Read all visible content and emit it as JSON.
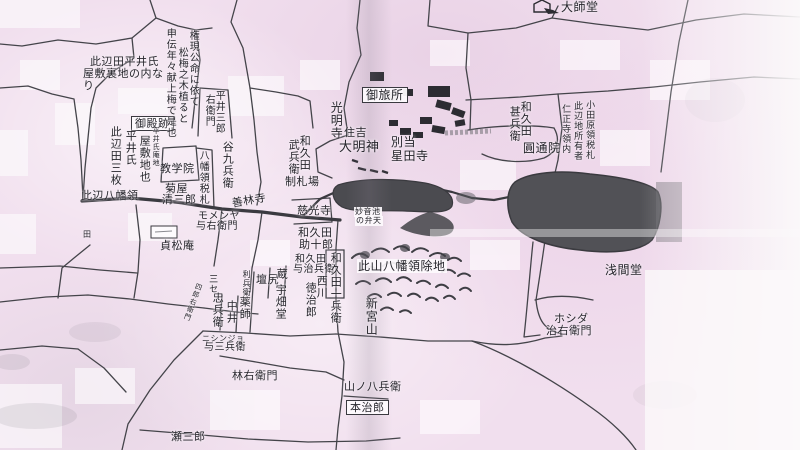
{
  "canvas": {
    "width": 800,
    "height": 450
  },
  "colors": {
    "paper_pink": "#f1dfee",
    "ink": "#26262c",
    "road": "#44444a",
    "road_main": "#3a3a40",
    "pond_fill": "#515156",
    "hill_stroke": "#3e3e44",
    "margin_white": "#fbf9fa"
  },
  "labels": [
    {
      "text": "大師堂",
      "x": 561,
      "y": 1,
      "dir": "h",
      "size": 12
    },
    {
      "text": "御旅所",
      "x": 362,
      "y": 87,
      "dir": "h",
      "size": 12,
      "box": true
    },
    {
      "text": "住吉",
      "x": 344,
      "y": 127,
      "dir": "h",
      "size": 11
    },
    {
      "text": "大明神",
      "x": 339,
      "y": 141,
      "dir": "h",
      "size": 13
    },
    {
      "text": "別当",
      "x": 391,
      "y": 136,
      "dir": "h",
      "size": 12
    },
    {
      "text": "星田寺",
      "x": 391,
      "y": 150,
      "dir": "h",
      "size": 12
    },
    {
      "text": "制札場",
      "x": 285,
      "y": 176,
      "dir": "h",
      "size": 11
    },
    {
      "text": "圓通院",
      "x": 523,
      "y": 142,
      "dir": "h",
      "size": 12
    },
    {
      "text": "教学院",
      "x": 160,
      "y": 163,
      "dir": "h",
      "size": 11
    },
    {
      "text": "菊屋",
      "x": 165,
      "y": 183,
      "dir": "h",
      "size": 11
    },
    {
      "text": "清三郎",
      "x": 162,
      "y": 194,
      "dir": "h",
      "size": 11
    },
    {
      "text": "此辺八幡領",
      "x": 81,
      "y": 190,
      "dir": "h",
      "size": 11
    },
    {
      "text": "善林寺",
      "x": 231,
      "y": 198,
      "dir": "h",
      "size": 11,
      "rot": -10
    },
    {
      "text": "慈光寺",
      "x": 297,
      "y": 205,
      "dir": "h",
      "size": 11
    },
    {
      "text": "モメンヤ",
      "x": 198,
      "y": 212,
      "dir": "h",
      "size": 10
    },
    {
      "text": "与右衛門",
      "x": 196,
      "y": 222,
      "dir": "h",
      "size": 10
    },
    {
      "text": "貞松庵",
      "x": 160,
      "y": 240,
      "dir": "h",
      "size": 11
    },
    {
      "text": "妙音池",
      "x": 354,
      "y": 207,
      "dir": "h",
      "size": 8,
      "bg": true
    },
    {
      "text": "の弁天",
      "x": 355,
      "y": 216,
      "dir": "h",
      "size": 8,
      "bg": true
    },
    {
      "text": "此山八幡領除地",
      "x": 357,
      "y": 259,
      "dir": "h",
      "size": 12,
      "bg": true
    },
    {
      "text": "浅間堂",
      "x": 605,
      "y": 264,
      "dir": "h",
      "size": 12
    },
    {
      "text": "ホシダ",
      "x": 554,
      "y": 313,
      "dir": "h",
      "size": 11
    },
    {
      "text": "治右衛門",
      "x": 546,
      "y": 325,
      "dir": "h",
      "size": 11
    },
    {
      "text": "ニシンジョ",
      "x": 202,
      "y": 335,
      "dir": "h",
      "size": 8
    },
    {
      "text": "与三兵衛",
      "x": 204,
      "y": 343,
      "dir": "h",
      "size": 10
    },
    {
      "text": "林右衛門",
      "x": 232,
      "y": 370,
      "dir": "h",
      "size": 11
    },
    {
      "text": "山ノ八兵衛",
      "x": 344,
      "y": 381,
      "dir": "h",
      "size": 11
    },
    {
      "text": "本治郎",
      "x": 346,
      "y": 400,
      "dir": "h",
      "size": 11,
      "box": true
    },
    {
      "text": "瀬三郎",
      "x": 171,
      "y": 431,
      "dir": "h",
      "size": 11
    },
    {
      "text": "壇尻",
      "x": 256,
      "y": 274,
      "dir": "h",
      "size": 11
    },
    {
      "text": "此辺田平井氏",
      "x": 90,
      "y": 56,
      "dir": "h",
      "size": 11
    },
    {
      "text": "屋敷裏地の内な",
      "x": 83,
      "y": 68,
      "dir": "h",
      "size": 11
    },
    {
      "text": "り",
      "x": 83,
      "y": 80,
      "dir": "h",
      "size": 11
    },
    {
      "text": "和久田",
      "x": 298,
      "y": 227,
      "dir": "h",
      "size": 11
    },
    {
      "text": "助十郎",
      "x": 299,
      "y": 239,
      "dir": "h",
      "size": 11
    },
    {
      "text": "和久田",
      "x": 295,
      "y": 255,
      "dir": "h",
      "size": 10
    },
    {
      "text": "与治兵衛",
      "x": 293,
      "y": 265,
      "dir": "h",
      "size": 10
    },
    {
      "text": "御殿跡",
      "x": 131,
      "y": 116,
      "dir": "h",
      "size": 11,
      "box": true
    },
    {
      "text": "田",
      "x": 83,
      "y": 231,
      "dir": "h",
      "size": 8
    },
    {
      "text": "権現公命に依て",
      "x": 187,
      "y": 30,
      "dir": "v",
      "size": 10
    },
    {
      "text": "松梅之木植ると",
      "x": 176,
      "y": 47,
      "dir": "v",
      "size": 10
    },
    {
      "text": "申伝年々献上梅で是也",
      "x": 164,
      "y": 28,
      "dir": "v",
      "size": 10
    },
    {
      "text": "平井三郎",
      "x": 213,
      "y": 90,
      "dir": "v",
      "size": 10
    },
    {
      "text": "右衛門",
      "x": 203,
      "y": 94,
      "dir": "v",
      "size": 10
    },
    {
      "text": "谷九兵衛",
      "x": 222,
      "y": 141,
      "dir": "v",
      "size": 11
    },
    {
      "text": "八幡領税札",
      "x": 197,
      "y": 150,
      "dir": "v",
      "size": 10
    },
    {
      "text": "此辺田三枚",
      "x": 110,
      "y": 126,
      "dir": "v",
      "size": 11
    },
    {
      "text": "平井氏",
      "x": 125,
      "y": 130,
      "dir": "v",
      "size": 11
    },
    {
      "text": "屋敷地也",
      "x": 139,
      "y": 135,
      "dir": "v",
      "size": 11
    },
    {
      "text": "平井氏庵地",
      "x": 152,
      "y": 127,
      "dir": "v",
      "size": 7
    },
    {
      "text": "和久田",
      "x": 299,
      "y": 135,
      "dir": "v",
      "size": 11
    },
    {
      "text": "武兵衛",
      "x": 288,
      "y": 139,
      "dir": "v",
      "size": 11
    },
    {
      "text": "光明寺",
      "x": 330,
      "y": 101,
      "dir": "v",
      "size": 12
    },
    {
      "text": "和久田",
      "x": 520,
      "y": 101,
      "dir": "v",
      "size": 11
    },
    {
      "text": "甚兵衛",
      "x": 509,
      "y": 106,
      "dir": "v",
      "size": 11
    },
    {
      "text": "小田原領税札",
      "x": 584,
      "y": 100,
      "dir": "v",
      "size": 9
    },
    {
      "text": "此辺地所有者",
      "x": 572,
      "y": 101,
      "dir": "v",
      "size": 9
    },
    {
      "text": "仁正寺領内",
      "x": 560,
      "y": 104,
      "dir": "v",
      "size": 9
    },
    {
      "text": "和久田一兵衛",
      "x": 330,
      "y": 252,
      "dir": "v",
      "size": 11
    },
    {
      "text": "西川",
      "x": 316,
      "y": 275,
      "dir": "v",
      "size": 11
    },
    {
      "text": "徳治郎",
      "x": 305,
      "y": 282,
      "dir": "v",
      "size": 11
    },
    {
      "text": "新宮山",
      "x": 365,
      "y": 297,
      "dir": "v",
      "size": 12
    },
    {
      "text": "薬師",
      "x": 239,
      "y": 296,
      "dir": "v",
      "size": 11
    },
    {
      "text": "忠兵衛",
      "x": 212,
      "y": 292,
      "dir": "v",
      "size": 11
    },
    {
      "text": "中井",
      "x": 226,
      "y": 300,
      "dir": "v",
      "size": 11
    },
    {
      "text": "利兵衛",
      "x": 242,
      "y": 270,
      "dir": "v",
      "size": 8
    },
    {
      "text": "三セ",
      "x": 207,
      "y": 274,
      "dir": "v",
      "size": 9
    },
    {
      "text": "四郎右衛門",
      "x": 196,
      "y": 282,
      "dir": "v",
      "size": 7,
      "rot": 20
    },
    {
      "text": "蔵",
      "x": 276,
      "y": 268,
      "dir": "v",
      "size": 11
    },
    {
      "text": "宇畑堂",
      "x": 275,
      "y": 284,
      "dir": "v",
      "size": 11
    }
  ]
}
